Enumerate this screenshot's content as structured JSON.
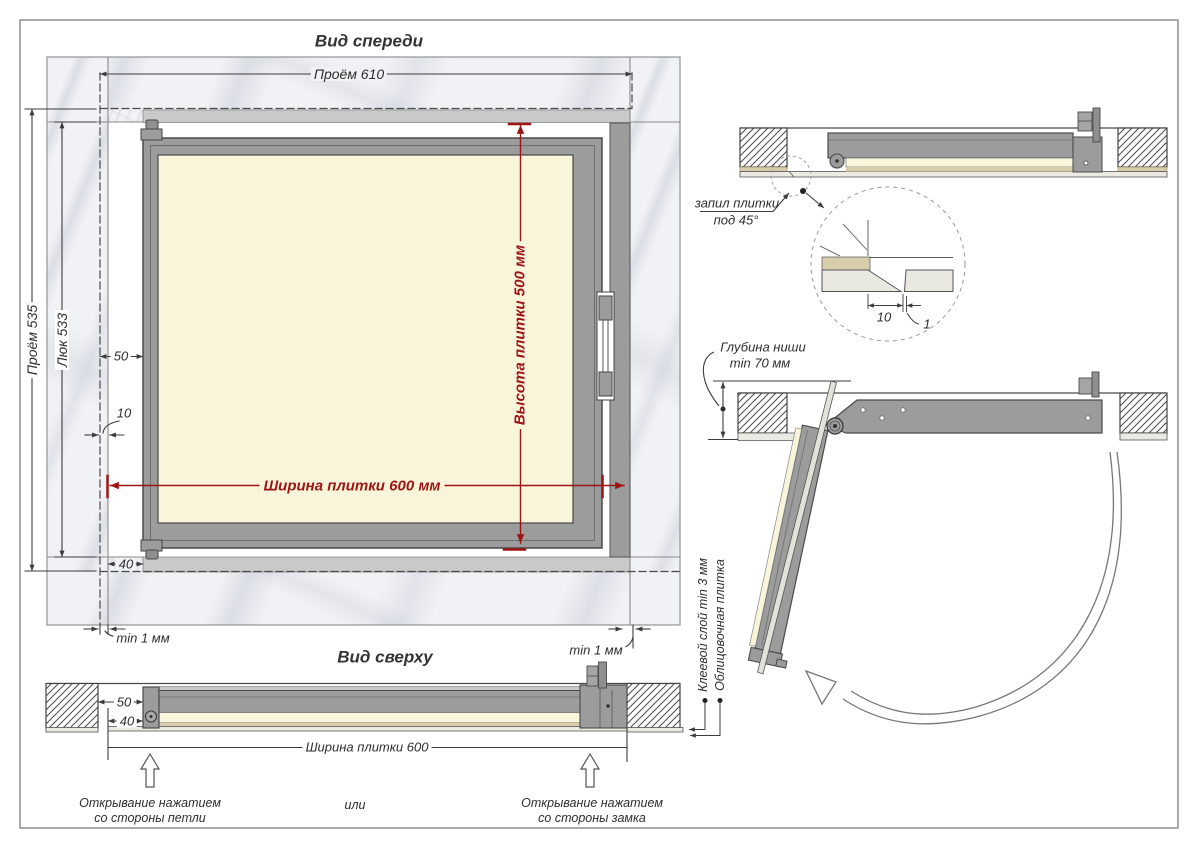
{
  "front_view": {
    "title": "Вид спереди",
    "dim_opening_width": "Проём 610",
    "dim_opening_height": "Проём 535",
    "dim_hatch_height": "Люк 533",
    "dim_50": "50",
    "dim_10": "10",
    "dim_40": "40",
    "dim_tile_width": "Ширина плитки 600 мм",
    "dim_tile_height": "Высота плитки 500 мм",
    "gap_left": "min 1 мм",
    "gap_right": "min 1 мм"
  },
  "section_view": {
    "cut_label_line1": "запил плитки",
    "cut_label_line2": "под 45°",
    "detail_dim_offset": "10",
    "detail_dim_gap": "1"
  },
  "open_view": {
    "niche_depth_line1": "Глубина ниши",
    "niche_depth_line2": "min 70 мм"
  },
  "top_view": {
    "title": "Вид сверху",
    "dim_50": "50",
    "dim_40": "40",
    "dim_tile_width": "Ширина плитки 600",
    "label_glue": "Клеевой слой min 3 мм",
    "label_tile": "Облицовочная плитка",
    "open_hinge_line1": "Открывание нажатием",
    "open_hinge_line2": "со стороны петли",
    "or_label": "или",
    "open_lock_line1": "Открывание нажатием",
    "open_lock_line2": "со стороны замка"
  },
  "colors": {
    "dimension_red": "#9e1414",
    "frame_gray": "#9c9c9c",
    "tile_cream": "#f8f5da",
    "line_dark": "#3c3c3c",
    "marble_light": "#f1f2f5"
  }
}
